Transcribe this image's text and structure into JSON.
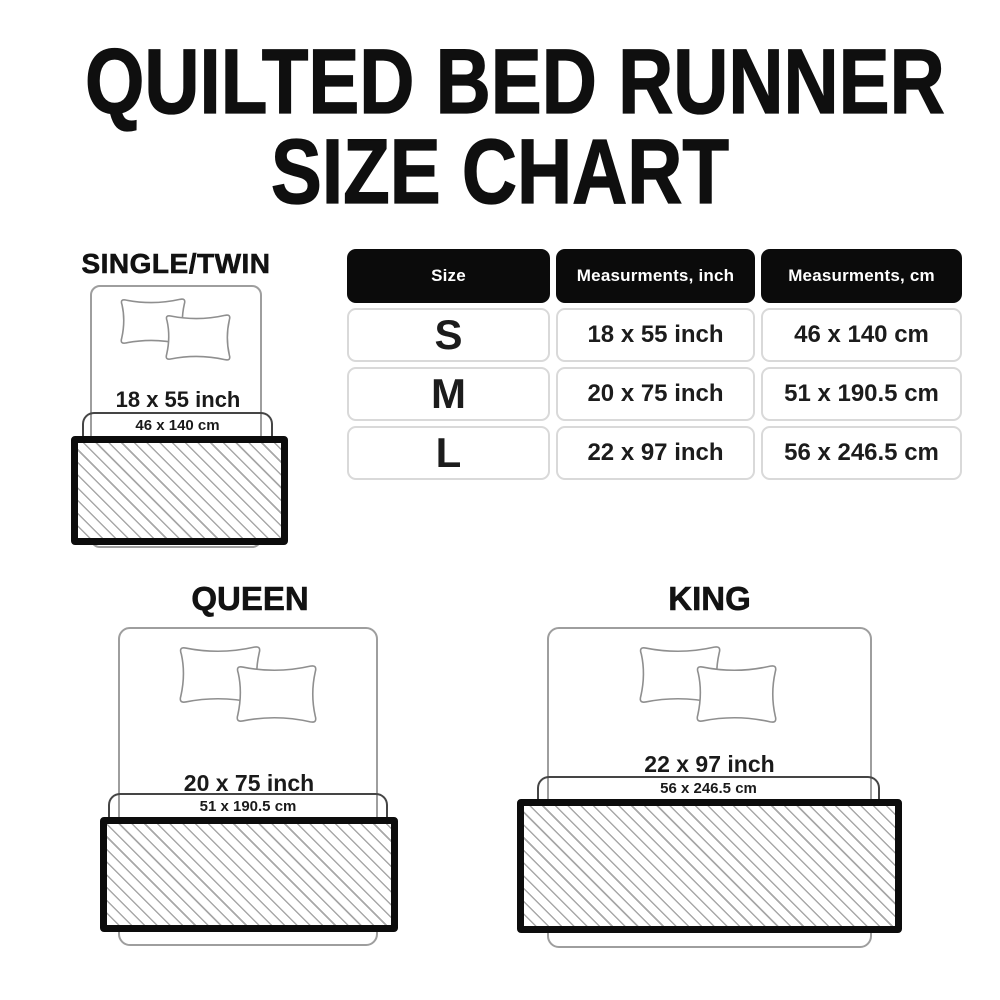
{
  "title": {
    "line1": "QUILTED BED RUNNER",
    "line2": "SIZE CHART"
  },
  "table": {
    "headers": {
      "size": "Size",
      "inch": "Measurments, inch",
      "cm": "Measurments, cm"
    },
    "rows": [
      {
        "size": "S",
        "inch": "18 x 55 inch",
        "cm": "46 x 140 cm"
      },
      {
        "size": "M",
        "inch": "20 x 75 inch",
        "cm": "51 x 190.5 cm"
      },
      {
        "size": "L",
        "inch": "22 x 97 inch",
        "cm": "56 x 246.5 cm"
      }
    ]
  },
  "diagrams": {
    "single": {
      "label": "SINGLE/TWIN",
      "inch": "18 x 55 inch",
      "cm": "46 x 140 cm"
    },
    "queen": {
      "label": "QUEEN",
      "inch": "20 x 75 inch",
      "cm": "51 x 190.5 cm"
    },
    "king": {
      "label": "KING",
      "inch": "22 x 97 inch",
      "cm": "56 x 246.5 cm"
    }
  },
  "colors": {
    "background": "#ffffff",
    "title_text": "#0f0f0f",
    "header_bg": "#0b0b0b",
    "header_text": "#ffffff",
    "cell_border": "#d9d9d9",
    "cell_text": "#1c1c1c",
    "bed_outline": "#9e9e9e",
    "bracket_line": "#454545",
    "runner_border": "#0c0c0c",
    "hatch_line": "#a8a8a8"
  }
}
